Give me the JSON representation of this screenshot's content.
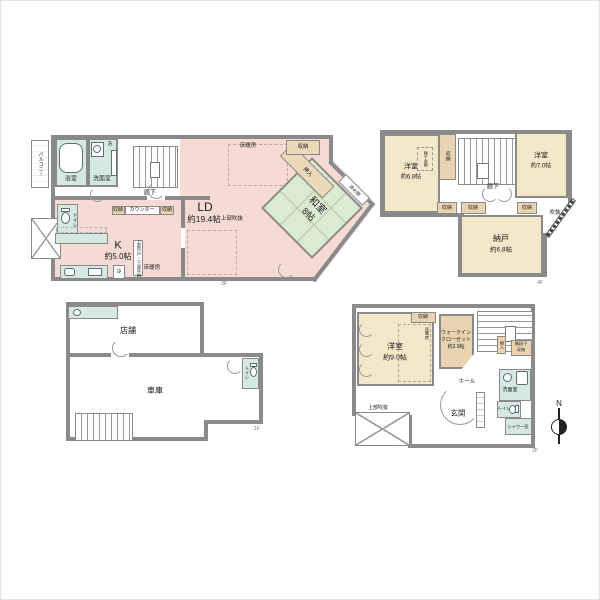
{
  "palette": {
    "wall": "#8a8a8a",
    "ld_pink": "#f6dbd5",
    "tatami_green": "#dcead2",
    "room_cream": "#f4e8cb",
    "closet_beige": "#e8d4b0",
    "wet_teal": "#d5e8e2"
  },
  "floor1": {
    "floor_label": "1F",
    "shop": "店舗",
    "garage": "車庫",
    "toilet": "トイレ"
  },
  "floor2": {
    "floor_label": "2F",
    "bedroom_name": "洋室",
    "bedroom_size": "約9.0帖",
    "closet": "収納",
    "floor_heating": "床暖房",
    "wic_line1": "ウォークイン",
    "wic_line2": "クローゼット",
    "wic_size": "約2.9帖",
    "storage_small": "物入",
    "under_stairs_line1": "階段下",
    "under_stairs_line2": "収納",
    "hall": "ホール",
    "entrance": "玄関",
    "washroom": "洗面室",
    "toilet": "トイレ",
    "shower": "シャワー室",
    "void_above": "上部吹抜",
    "compass_north": "N"
  },
  "floor3": {
    "floor_label": "3F",
    "balcony": "バルコニー",
    "bath": "浴室",
    "washer": "洗",
    "washroom": "洗面室",
    "hallway": "廊下",
    "toilet": "トイレ",
    "storage_left": "収納",
    "counter": "カウンター",
    "storage_right": "収納",
    "kitchen_name": "K",
    "kitchen_size": "約5.0帖",
    "fridge": "冷",
    "cupboard": "上部吊戸・下部収納",
    "floor_heating": "床暖房",
    "ld_name": "LD",
    "ld_size": "約19.4帖",
    "void_above": "上部吹抜",
    "washitsu_name": "和室",
    "washitsu_size": "8帖",
    "oshiire": "押入",
    "storage_top": "収納",
    "tokonoma": "床の間"
  },
  "floor4": {
    "floor_label": "4F",
    "bedroom_left_name": "洋室",
    "bedroom_left_size": "約6.8帖",
    "laundry_fitting": "物干金物",
    "closet_left": "収納",
    "bedroom_right_name": "洋室",
    "bedroom_right_size": "約7.0帖",
    "hallway": "廊下",
    "closets": [
      "収納",
      "収納",
      "収納"
    ],
    "storeroom_name": "納戸",
    "storeroom_size": "約6.8帖",
    "void": "吹抜"
  }
}
